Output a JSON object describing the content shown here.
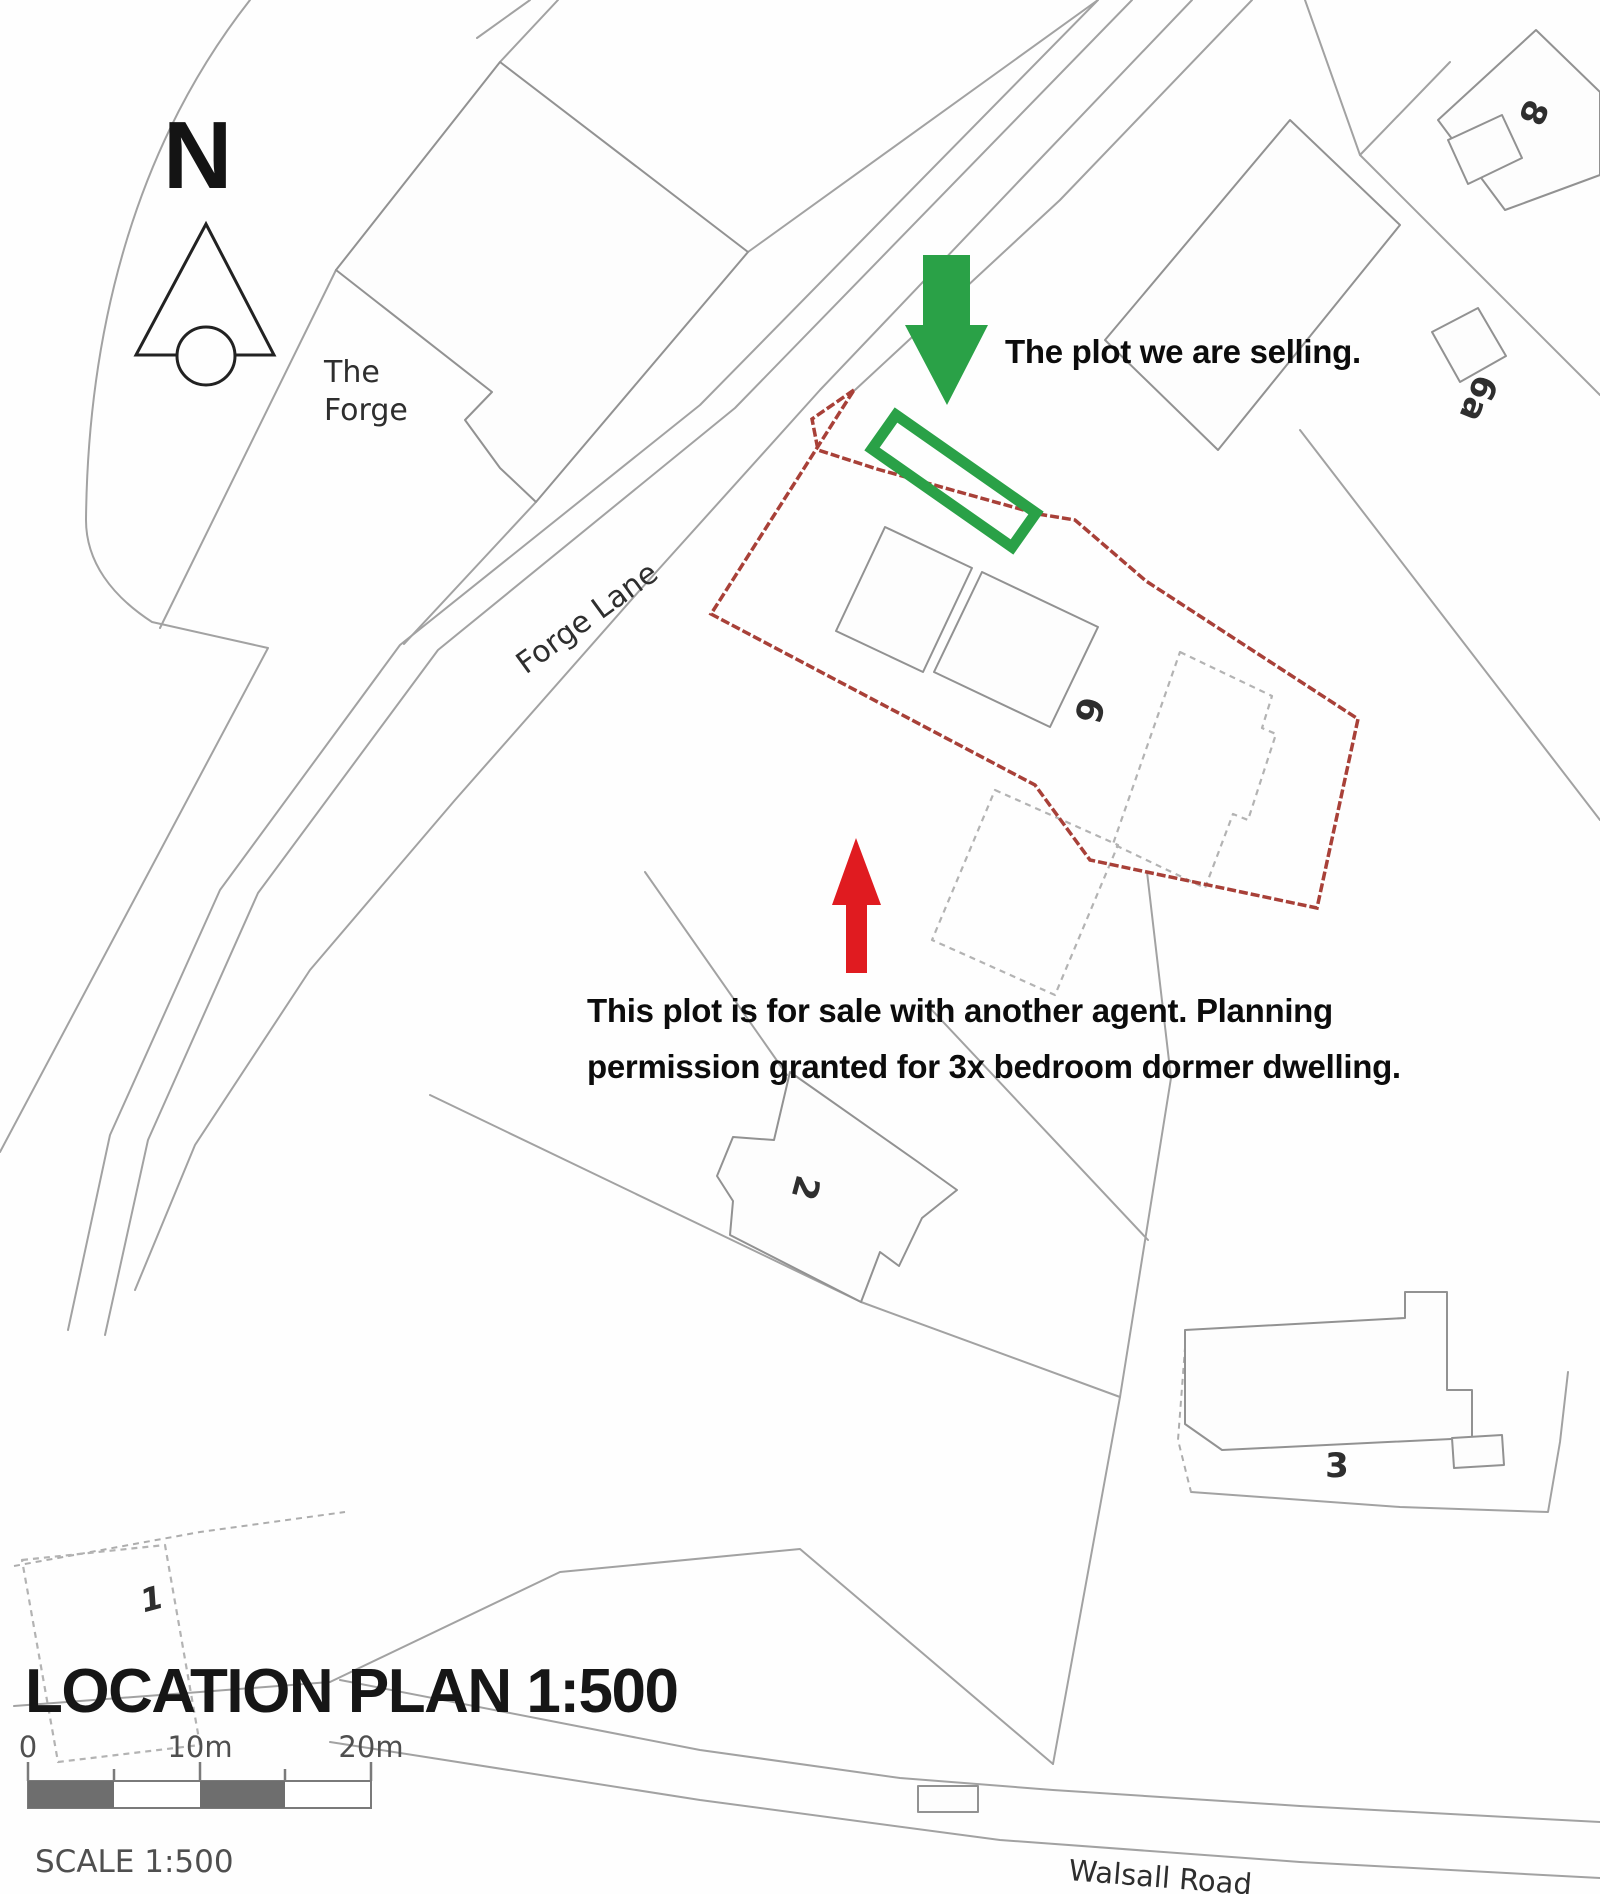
{
  "title": {
    "heading": "LOCATION PLAN 1:500",
    "scale_label": "SCALE 1:500"
  },
  "scale_bar": {
    "tick_0": "0",
    "tick_10": "10m",
    "tick_20": "20m"
  },
  "annotations": {
    "selling_note": "The plot we are selling.",
    "other_agent_note_line1": "This plot is for sale with another agent. Planning",
    "other_agent_note_line2": "permission granted for 3x bedroom dormer dwelling."
  },
  "map_labels": {
    "north": "N",
    "the_forge_line1": "The",
    "the_forge_line2": "Forge",
    "forge_lane": "Forge Lane",
    "walsall_road": "Walsall Road",
    "house_8": "8",
    "house_6a": "6a",
    "house_6": "6",
    "house_2": "2",
    "house_3": "3",
    "house_1": "1"
  },
  "colors": {
    "plot_highlight_green": "#2aa147",
    "arrow_red": "#e01b20",
    "site_boundary_red": "#a84038"
  }
}
